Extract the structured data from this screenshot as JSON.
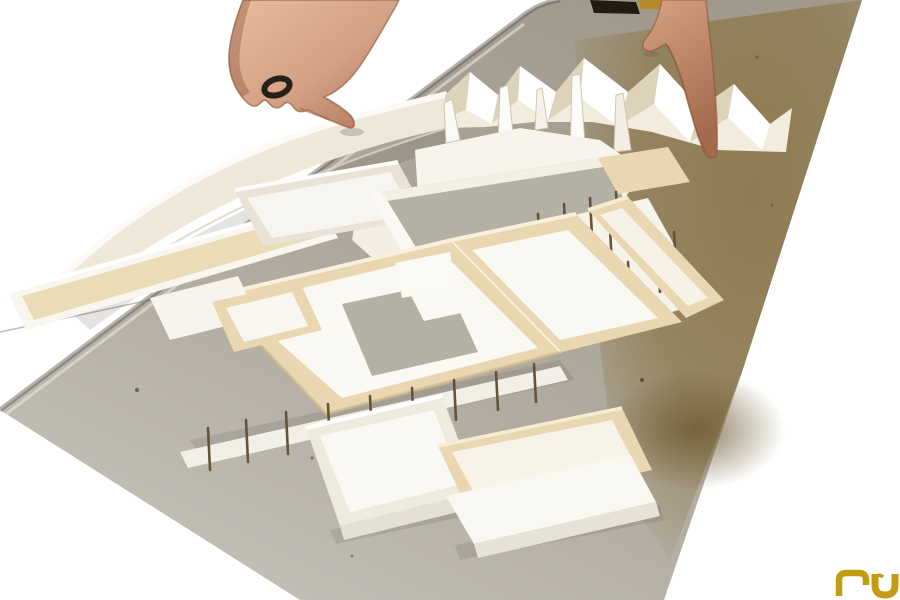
{
  "photo": {
    "description": "Photograph of a white and balsa-wood architectural scale model on a large grey chipboard base; two hands reach in from the top edge to adjust paper walls.",
    "subject_parts": {
      "base_board": "grey chipboard base with brown-stained right edge",
      "left_hand": "left hand with dark ring touching model edge",
      "right_hand": "right hand fingers adjusting zig-zag paper wall",
      "model": "balsa courtyard boxes, grey card roof plates, white card trays, thin timber columns"
    }
  },
  "colors": {
    "background": "#ffffff",
    "board_gray": "#a9a399",
    "board_light": "#c9c6be",
    "board_dark_edge": "#5e5952",
    "board_brown": "#8e7a4e",
    "board_brown_deep": "#6e5a30",
    "balsa": "#e8d7b0",
    "balsa_light": "#f4ead2",
    "balsa_shadow": "#d5bf92",
    "card_white": "#faf8f2",
    "card_cream": "#efe8d8",
    "card_shadow": "#e0dbce",
    "roof_gray": "#b4b0a4",
    "stilt_brown": "#64553a",
    "skin": "#d8a88b",
    "skin_shadow": "#a06848",
    "skin_dark": "#7a4935",
    "ring_black": "#262019",
    "watch_dark": "#211b12",
    "watch_gold": "#b8892c",
    "logo_gold": "#c49c12"
  },
  "logo": {
    "text": "nu",
    "color": "#c49c12"
  }
}
